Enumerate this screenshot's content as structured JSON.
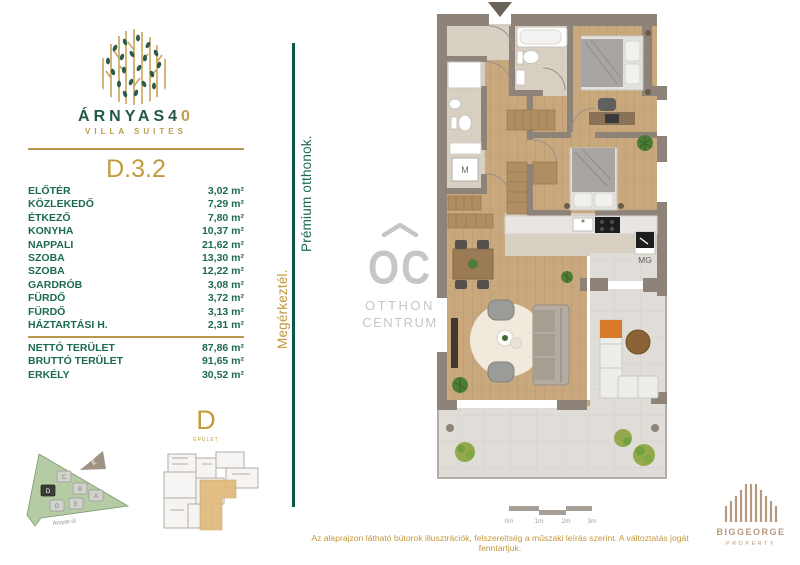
{
  "brand": {
    "name": "ÁRNYAS",
    "number_dark": "4",
    "number_gold": "0",
    "subtitle": "VILLA SUITES"
  },
  "unit": {
    "id": "D.3.2",
    "rooms": [
      {
        "name": "ELŐTÉR",
        "area": "3,02 m²"
      },
      {
        "name": "KÖZLEKEDŐ",
        "area": "7,29 m²"
      },
      {
        "name": "ÉTKEZŐ",
        "area": "7,80 m²"
      },
      {
        "name": "KONYHA",
        "area": "10,37 m²"
      },
      {
        "name": "NAPPALI",
        "area": "21,62 m²"
      },
      {
        "name": "SZOBA",
        "area": "13,30 m²"
      },
      {
        "name": "SZOBA",
        "area": "12,22 m²"
      },
      {
        "name": "GARDRÓB",
        "area": "3,08 m²"
      },
      {
        "name": "FÜRDŐ",
        "area": "3,72 m²"
      },
      {
        "name": "FÜRDŐ",
        "area": "3,13 m²"
      },
      {
        "name": "HÁZTARTÁSI H.",
        "area": "2,31 m²"
      }
    ],
    "totals": [
      {
        "name": "NETTÓ TERÜLET",
        "area": "87,86 m²"
      },
      {
        "name": "BRUTTÓ TERÜLET",
        "area": "91,65 m²"
      },
      {
        "name": "ERKÉLY",
        "area": "30,52 m²"
      }
    ]
  },
  "slogan": {
    "arrive": "Megérkeztél.",
    "premium": "Prémium otthonok."
  },
  "watermark": {
    "initials": "OC",
    "line1": "OTTHON",
    "line2": "CENTRUM"
  },
  "floorplan_labels": {
    "washer": "M",
    "appliance": "MG"
  },
  "siteplan": {
    "street": "Árnyas út",
    "north": "É",
    "buildings": [
      "C",
      "D",
      "B",
      "A",
      "G",
      "E"
    ],
    "highlighted_building": "D"
  },
  "building_key": {
    "letter": "D",
    "sublabel": "ÉPÜLET"
  },
  "scalebar": {
    "labels": [
      "0m",
      "1m",
      "2m",
      "3m"
    ]
  },
  "footer": {
    "disclaimer": "Az alaprajzon látható bútorok illusztrációk, felszereltség a műszaki leírás szerint. A változtatás jogát fenntartjuk."
  },
  "developer": {
    "name": "BIGGEORGE",
    "division": "PROPERTY"
  },
  "colors": {
    "brand_green": "#1d6a52",
    "brand_gold": "#c49b3c",
    "deep_teal_line": "#0d574a",
    "wall": "#8d8379",
    "wood_floor": "#c9a87e",
    "bath_tile": "#d8d1c3",
    "terrace": "#e0ddd8",
    "highlight_unit": "#dfb97b",
    "watermark_gray": "#c6c6c6",
    "developer_tan": "#b59a7e"
  }
}
